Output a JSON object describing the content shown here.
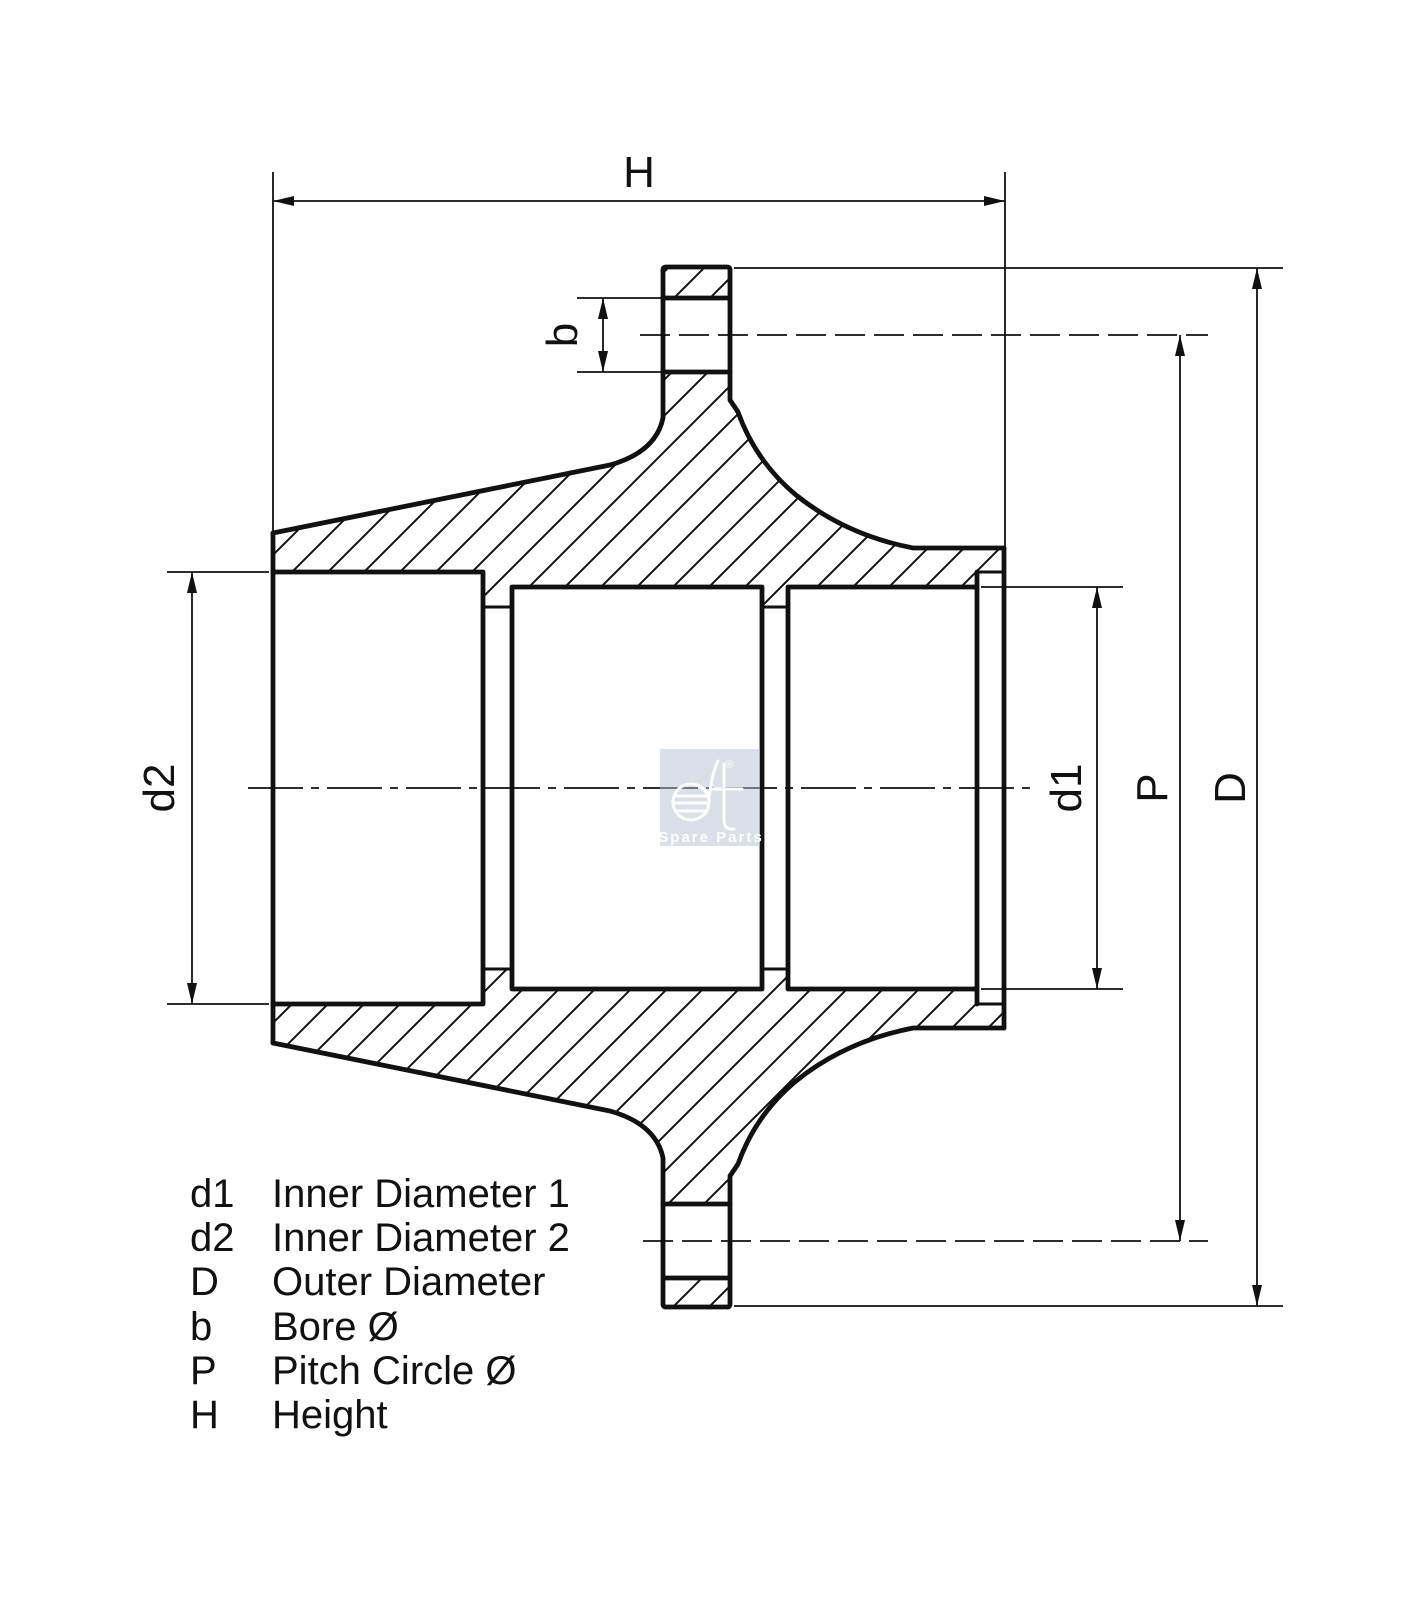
{
  "drawing": {
    "labels": {
      "height": "H",
      "bore": "b",
      "inner_d1": "d1",
      "inner_d2": "d2",
      "pitch": "P",
      "outer": "D"
    },
    "legend": [
      {
        "symbol": "d1",
        "label": "Inner Diameter 1"
      },
      {
        "symbol": "d2",
        "label": "Inner Diameter 2"
      },
      {
        "symbol": "D",
        "label": "Outer Diameter"
      },
      {
        "symbol": "b",
        "label": "Bore Ø"
      },
      {
        "symbol": "P",
        "label": "Pitch Circle Ø"
      },
      {
        "symbol": "H",
        "label": "Height"
      }
    ],
    "watermark": {
      "brand": "dt",
      "registered": "®",
      "tagline": "Spare Parts"
    },
    "colors": {
      "line": "#111111",
      "background": "#ffffff",
      "watermark_fill": "#b7c0d2"
    }
  }
}
